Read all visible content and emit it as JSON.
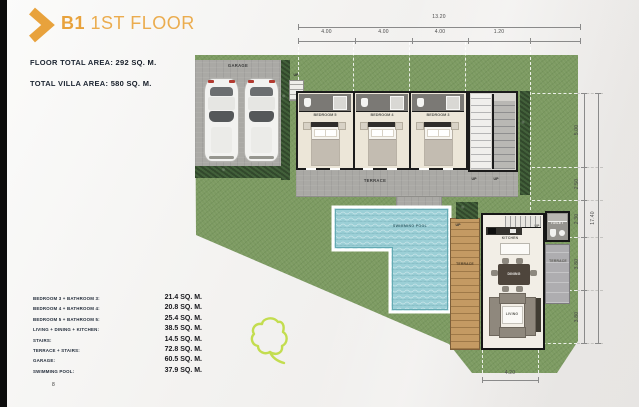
{
  "header": {
    "title_b": "B1",
    "title_rest": " 1ST FLOOR",
    "floor_area_label": "FLOOR TOTAL AREA: ",
    "floor_area_value": "292 SQ. M.",
    "villa_area_label": "TOTAL VILLA AREA: ",
    "villa_area_value": "580 SQ. M."
  },
  "legend": {
    "rows": [
      {
        "label": "BEDROOM 3 + BATHROOM 3:",
        "value": "21.4 SQ. M."
      },
      {
        "label": "BEDROOM 4 + BATHROOM 4:",
        "value": "20.8 SQ. M."
      },
      {
        "label": "BEDROOM 5 + BATHROOM 5:",
        "value": "25.4 SQ. M."
      },
      {
        "label": "LIVING + DINING + KITCHEN:",
        "value": "38.5 SQ. M."
      },
      {
        "label": "STAIRS:",
        "value": "14.5 SQ. M."
      },
      {
        "label": "TERRACE + STAIRS:",
        "value": "72.8 SQ. M."
      },
      {
        "label": "GARAGE:",
        "value": "60.5 SQ. M."
      },
      {
        "label": "SWIMMING POOL:",
        "value": "37.9 SQ. M."
      }
    ]
  },
  "page_number": "8",
  "plan": {
    "labels": {
      "garage": "GARAGE",
      "bedroom_left": "BEDROOM 5",
      "bedroom_mid": "BEDROOM 4",
      "bedroom_right": "BEDROOM 3",
      "terrace": "TERRACE",
      "swimming_pool": "SWIMMING POOL",
      "terrace_wood": "TERRACE",
      "terrace_right": "TERRACE",
      "kitchen": "KITCHEN",
      "dining": "DINING",
      "living": "LIVING",
      "toilet": "TOILET",
      "up": "UP"
    },
    "dimensions": {
      "top": {
        "overall": "13.20",
        "segments": [
          "4.00",
          "4.00",
          "4.00",
          "1.20"
        ]
      },
      "right": {
        "overall": "17.40",
        "segments": [
          "5.00",
          "2.50",
          "2.30",
          "3.80",
          "3.80"
        ]
      },
      "bottom": {
        "overall": "4.20"
      }
    },
    "colors": {
      "accent": "#E8A23C",
      "grass": "#7D9B62",
      "hedge": "#42603A",
      "pool_water": "#9CCFD6",
      "wood_deck": "#C49A63",
      "concrete": "#ACABA7",
      "wall": "#1B1B1B",
      "text_dark": "#1D2633",
      "leaf_outline": "#C3DD4F"
    }
  }
}
